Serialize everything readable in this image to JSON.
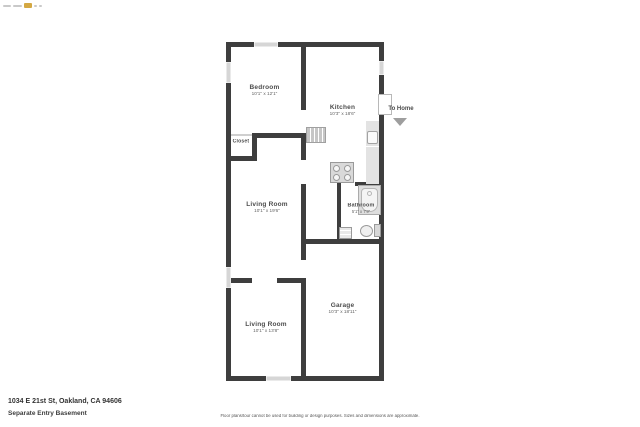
{
  "meta": {
    "address": "1034 E 21st St, Oakland, CA 94606",
    "subtitle": "Separate Entry Basement",
    "disclaimer": "Floor plans/tour cannot be used for building or design purposes. Sizes and dimensions are approximate."
  },
  "colors": {
    "wall": "#3e3e3e",
    "window": "#d6d6d6",
    "fixture_fill": "#e3e3e3",
    "fixture_border": "#9a9a9a",
    "label_text": "#4c4c4c",
    "dims_text": "#636363",
    "arrow": "#9e9e9e",
    "logo_gray": "#c9c9c9",
    "logo_gold": "#d4a843"
  },
  "rooms": [
    {
      "id": "bedroom",
      "name": "Bedroom",
      "dims": "10'1\" x 12'1\""
    },
    {
      "id": "kitchen",
      "name": "Kitchen",
      "dims": "10'3\" x 18'6\""
    },
    {
      "id": "closet",
      "name": "Closet",
      "dims": ""
    },
    {
      "id": "living-room-1",
      "name": "Living Room",
      "dims": "10'1\" x 19'6\""
    },
    {
      "id": "bathroom",
      "name": "Bathroom",
      "dims": "5'1\" x 7'9\""
    },
    {
      "id": "garage",
      "name": "Garage",
      "dims": "10'3\" x 18'11\""
    },
    {
      "id": "living-room-2",
      "name": "Living Room",
      "dims": "10'1\" x 13'8\""
    }
  ],
  "annotations": {
    "to_home": "To Home"
  }
}
